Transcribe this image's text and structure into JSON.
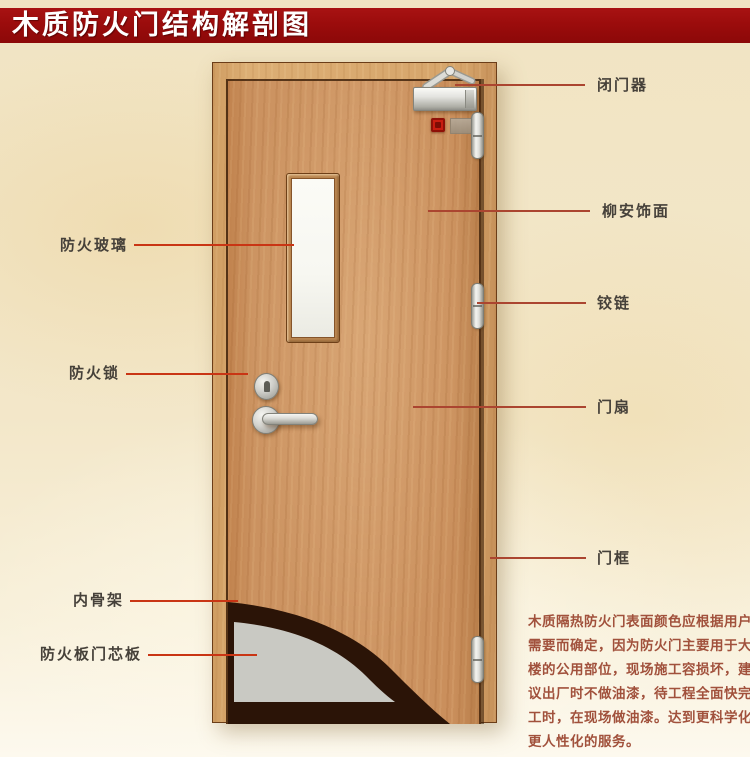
{
  "title": "木质防火门结构解剖图",
  "labels": {
    "left": [
      {
        "id": "fire-glass",
        "text": "防火玻璃"
      },
      {
        "id": "fire-lock",
        "text": "防火锁"
      },
      {
        "id": "inner-skeleton",
        "text": "内骨架"
      },
      {
        "id": "core-board",
        "text": "防火板门芯板"
      }
    ],
    "right": [
      {
        "id": "door-closer",
        "text": "闭门器"
      },
      {
        "id": "lauan-veneer",
        "text": "柳安饰面"
      },
      {
        "id": "hinge",
        "text": "铰链"
      },
      {
        "id": "door-leaf",
        "text": "门扇"
      },
      {
        "id": "door-frame",
        "text": "门框"
      }
    ]
  },
  "description_lines": [
    "木质隔热防火门表面颜色应根据用户",
    "需要而确定，因为防火门主要用于大",
    "楼的公用部位，现场施工容损坏，建",
    "议出厂时不做油漆，待工程全面快完",
    "工时，在现场做油漆。达到更科学化",
    "更人性化的服务。"
  ],
  "colors": {
    "banner_bg": "#9b0c0c",
    "banner_text": "#ffffff",
    "background": "#f2e5c5",
    "door_wood": "#cb9260",
    "frame_wood": "#d9a96e",
    "leader_left": "#c93514",
    "leader_right": "#ab4530",
    "label_text": "#46413a",
    "description_text": "#a1513c",
    "glass": "#f7f7f1",
    "core_board": "#c9c9c3",
    "inner_skeleton": "#2b1407",
    "hardware_metal": "#d9d9d4"
  }
}
